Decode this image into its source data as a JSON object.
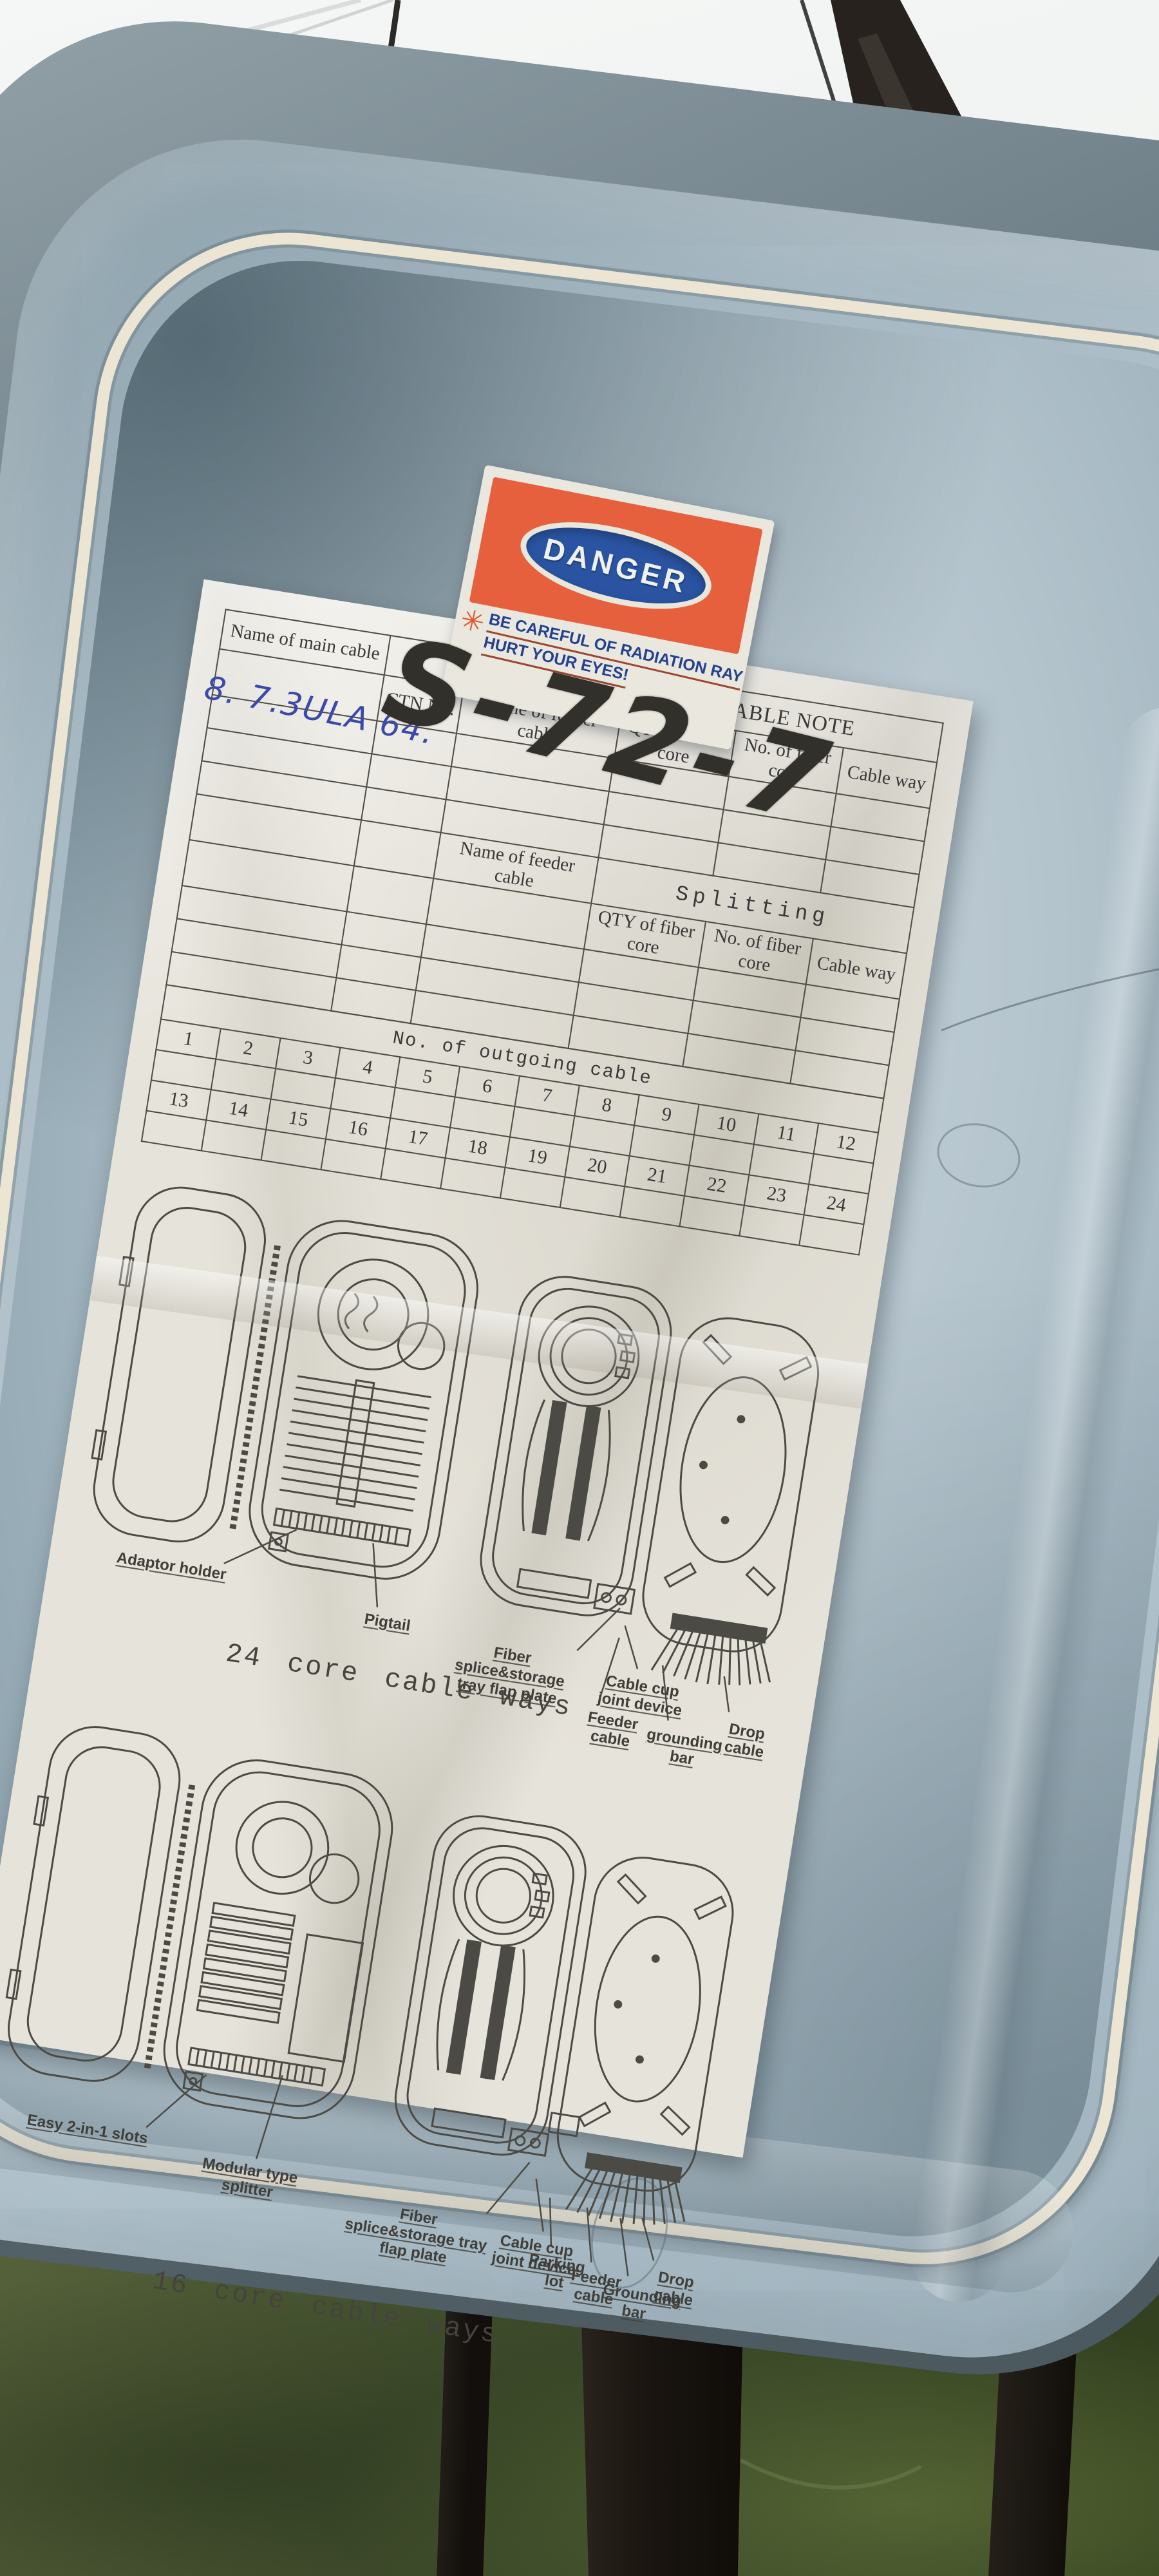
{
  "colors": {
    "box_gray": "#aebfc9",
    "gasket_cream": "#ece5d3",
    "paper": "#e6e3da",
    "sticker_orange": "#e7603e",
    "sticker_blue": "#2a54a2",
    "warning_text_blue": "#24418f",
    "underline_red": "#9c4631",
    "pen_blue": "#3c49a8",
    "marker_black": "#32302b",
    "grass_green": "#445230"
  },
  "sticker": {
    "title": "DANGER",
    "warning_line1": "BE CAREFUL OF RADIATION RAY",
    "warning_line2": "HURT YOUR EYES!"
  },
  "handwriting": {
    "box_code": "S-72-7",
    "pen_note": "8. 7.3ULA 64."
  },
  "table": {
    "title": "OPTICAL FIBER CABLE NOTE",
    "main_cable_label": "Name of main cable",
    "ctn_label": "CTN No.",
    "feeder_label": "Name of feeder cable",
    "qty_label": "QTY of fiber core",
    "core_label": "No. of fiber core",
    "way_label": "Cable way",
    "splitting_label": "Splitting",
    "outgoing_label": "No. of outgoing cable",
    "outgoing_row1": [
      "1",
      "2",
      "3",
      "4",
      "5",
      "6",
      "7",
      "8",
      "9",
      "10",
      "11",
      "12"
    ],
    "outgoing_row2": [
      "13",
      "14",
      "15",
      "16",
      "17",
      "18",
      "19",
      "20",
      "21",
      "22",
      "23",
      "24"
    ]
  },
  "diagrams": {
    "top": {
      "caption": "24 core cable ways",
      "labels": {
        "adaptor": "Adaptor holder",
        "pigtail": "Pigtail",
        "tray": "Fiber splice&storage tray flap plate",
        "cup": "Cable cup joint device",
        "feeder": "Feeder cable",
        "grounding": "grounding bar",
        "drop": "Drop cable"
      }
    },
    "bottom": {
      "caption": "16 core cable ways",
      "labels": {
        "slots": "Easy 2-in-1 slots",
        "splitter": "Modular type splitter",
        "tray": "Fiber splice&storage tray flap plate",
        "cup": "Cable cup joint device",
        "parking": "Parking lot",
        "feeder": "Feeder cable",
        "grounding": "Grounding bar",
        "drop": "Drop cable"
      }
    }
  }
}
